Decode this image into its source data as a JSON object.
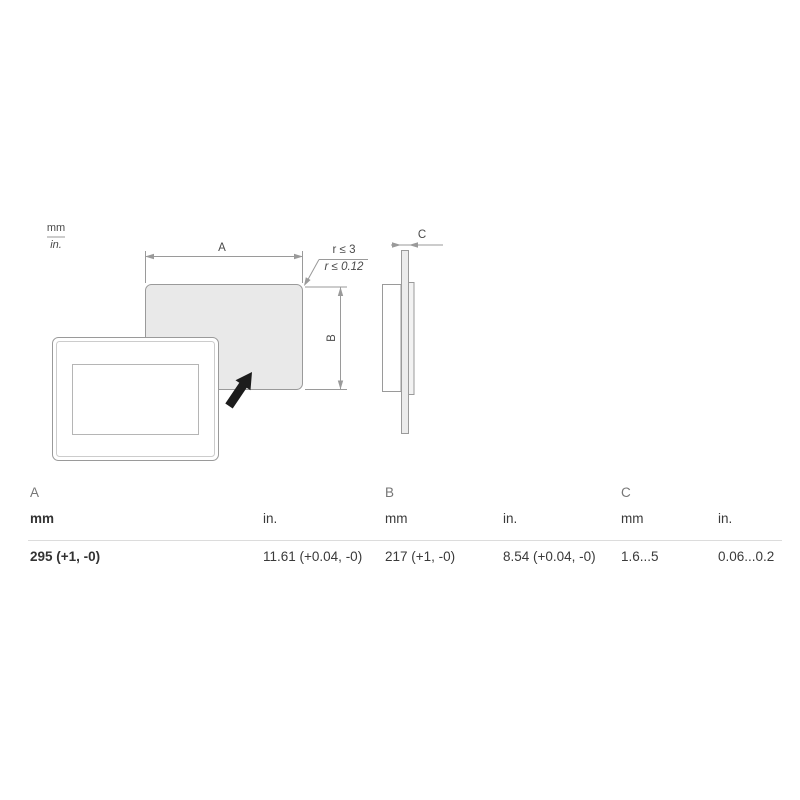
{
  "colors": {
    "drawing_line": "#9a9a9a",
    "cutout_fill": "#e9e9e9",
    "side_strip_fill": "#ececec",
    "arrow_black": "#1c1c1c",
    "table_divider": "#dcdcdc",
    "table_group_label": "#767676",
    "table_text": "#3a3a3a"
  },
  "units_badge": {
    "mm": "mm",
    "in": "in."
  },
  "drawing": {
    "dim_a": "A",
    "dim_b": "B",
    "dim_c": "C",
    "radius_mm": "r ≤ 3",
    "radius_in": "r ≤ 0.12"
  },
  "table": {
    "unit_mm": "mm",
    "unit_in": "in.",
    "groups": [
      {
        "label": "A",
        "mm": "295 (+1, -0)",
        "in": "11.61 (+0.04, -0)"
      },
      {
        "label": "B",
        "mm": "217 (+1, -0)",
        "in": "8.54 (+0.04, -0)"
      },
      {
        "label": "C",
        "mm": "1.6...5",
        "in": "0.06...0.2"
      }
    ]
  }
}
